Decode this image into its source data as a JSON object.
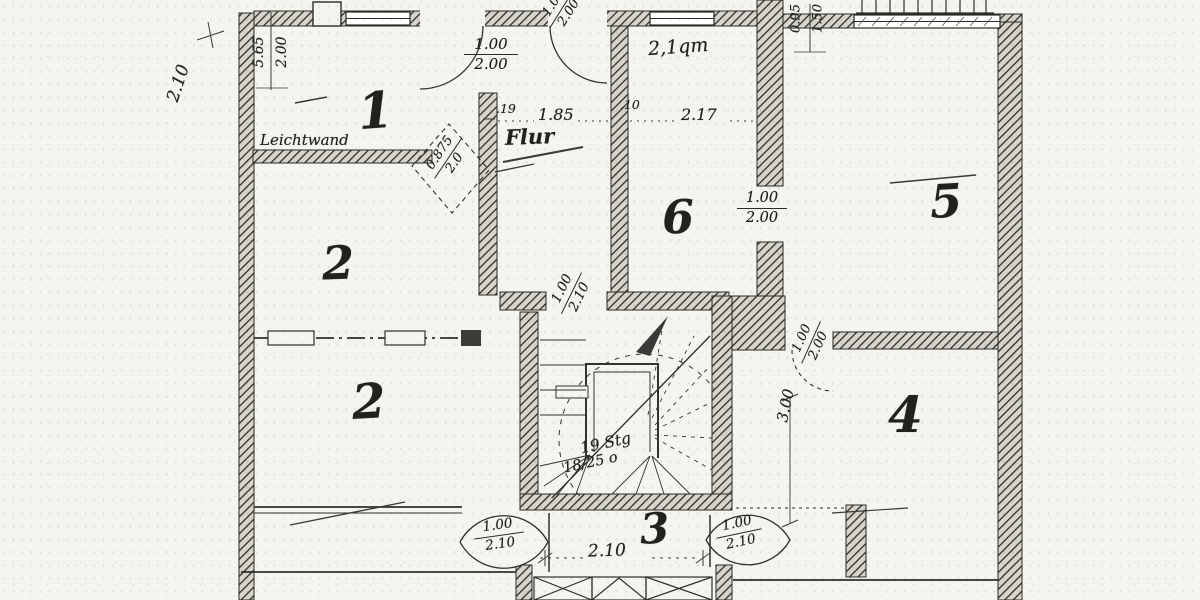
{
  "plan": {
    "rooms": {
      "r1": "1",
      "r2_upper": "2",
      "r2_lower": "2",
      "r3": "3",
      "r4": "4",
      "r5": "5",
      "r6": "6"
    },
    "labels": {
      "flur": "Flur",
      "leichtwand": "Leichtwand",
      "small_room_area": "2,1qm",
      "stair_steps": "19 Stg",
      "stair_rise_run": "18/25 o"
    },
    "dims": {
      "left_height": "2.10",
      "top_left_width": "5.65",
      "top_left_height": "2.00",
      "wall_thickness_19": ".19",
      "flur_width": "1.85",
      "wall_thickness_10": ".10",
      "room6_width": "2.17",
      "top_right_a": "0.95",
      "top_right_b": "1.50",
      "room4_depth": "3.00",
      "corridor_width": "2.10"
    },
    "doors": {
      "room1_top": {
        "num": "1.00",
        "den": "2.00"
      },
      "flur_top": {
        "num": "1.00",
        "den": "2.00"
      },
      "leichtwand": {
        "num": "0.875",
        "den": "2.0"
      },
      "room5": {
        "num": "1.00",
        "den": "2.00"
      },
      "room4": {
        "num": "1.00",
        "den": "2.00"
      },
      "stairwell": {
        "num": "1.00",
        "den": "2.10"
      },
      "corridor_left": {
        "num": "1.00",
        "den": "2.10"
      },
      "corridor_right": {
        "num": "1.00",
        "den": "2.10"
      }
    }
  }
}
